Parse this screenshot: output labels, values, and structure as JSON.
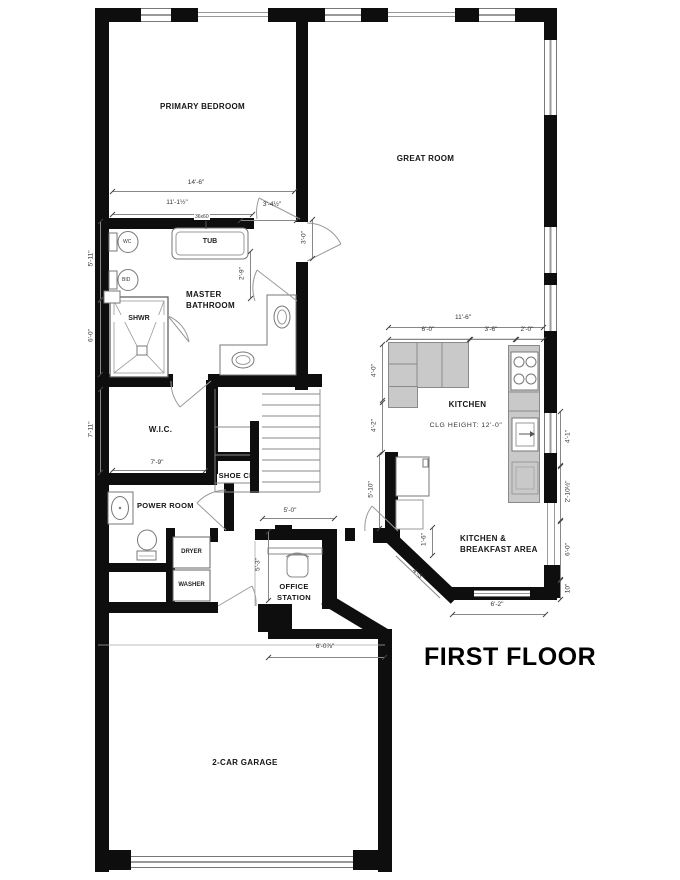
{
  "title": "FIRST FLOOR",
  "rooms": {
    "primary_bedroom": "PRIMARY BEDROOM",
    "great_room": "GREAT ROOM",
    "master_bathroom": "MASTER\nBATHROOM",
    "wic": "W.I.C.",
    "shoe_closet": "SHOE CL.",
    "power_room": "POWER ROOM",
    "office": "OFFICE\nSTATION",
    "kitchen": "KITCHEN",
    "breakfast": "KITCHEN &\nBREAKFAST AREA",
    "garage": "2-CAR GARAGE"
  },
  "fixtures": {
    "tub": "TUB",
    "tub_size": "36x60",
    "shower": "SHWR",
    "wc": "WC",
    "bidet": "BID",
    "dryer": "DRYER",
    "washer": "WASHER"
  },
  "notes": {
    "ceiling": "CLG HEIGHT: 12'-0\""
  },
  "dims": {
    "bed1": "14'-6\"",
    "bed2": "11'-1½\"",
    "vest_w": "3'-4½\"",
    "vest_h": "3'-0\"",
    "tub_clear": "2'-9\"",
    "left1": "5'-11\"",
    "left2": "6'-0\"",
    "left3": "7'-11\"",
    "wic_w": "7'-9\"",
    "office_w": "5'-0\"",
    "office_h": "5'-3\"",
    "kit_total": "11'-6\"",
    "kit_a": "6'-0\"",
    "kit_b": "3'-6\"",
    "kit_c": "2'-0\"",
    "kit_l1": "4'-0\"",
    "kit_l2": "4'-2\"",
    "kit_l3": "5'-10\"",
    "kit_r1": "4'-1\"",
    "kit_r2": "2'-10½\"",
    "kit_r3": "6'-0\"",
    "kit_r4": "10\"",
    "brk_v": "1'-6\"",
    "brk_diag": "4'-3\"",
    "brk_w": "6'-2\"",
    "garage_w": "6'-0⅞\""
  },
  "colors": {
    "wall": "#0e0e0e",
    "counter": "#c9c9c9",
    "outline": "#777777",
    "dimline": "#888888"
  }
}
